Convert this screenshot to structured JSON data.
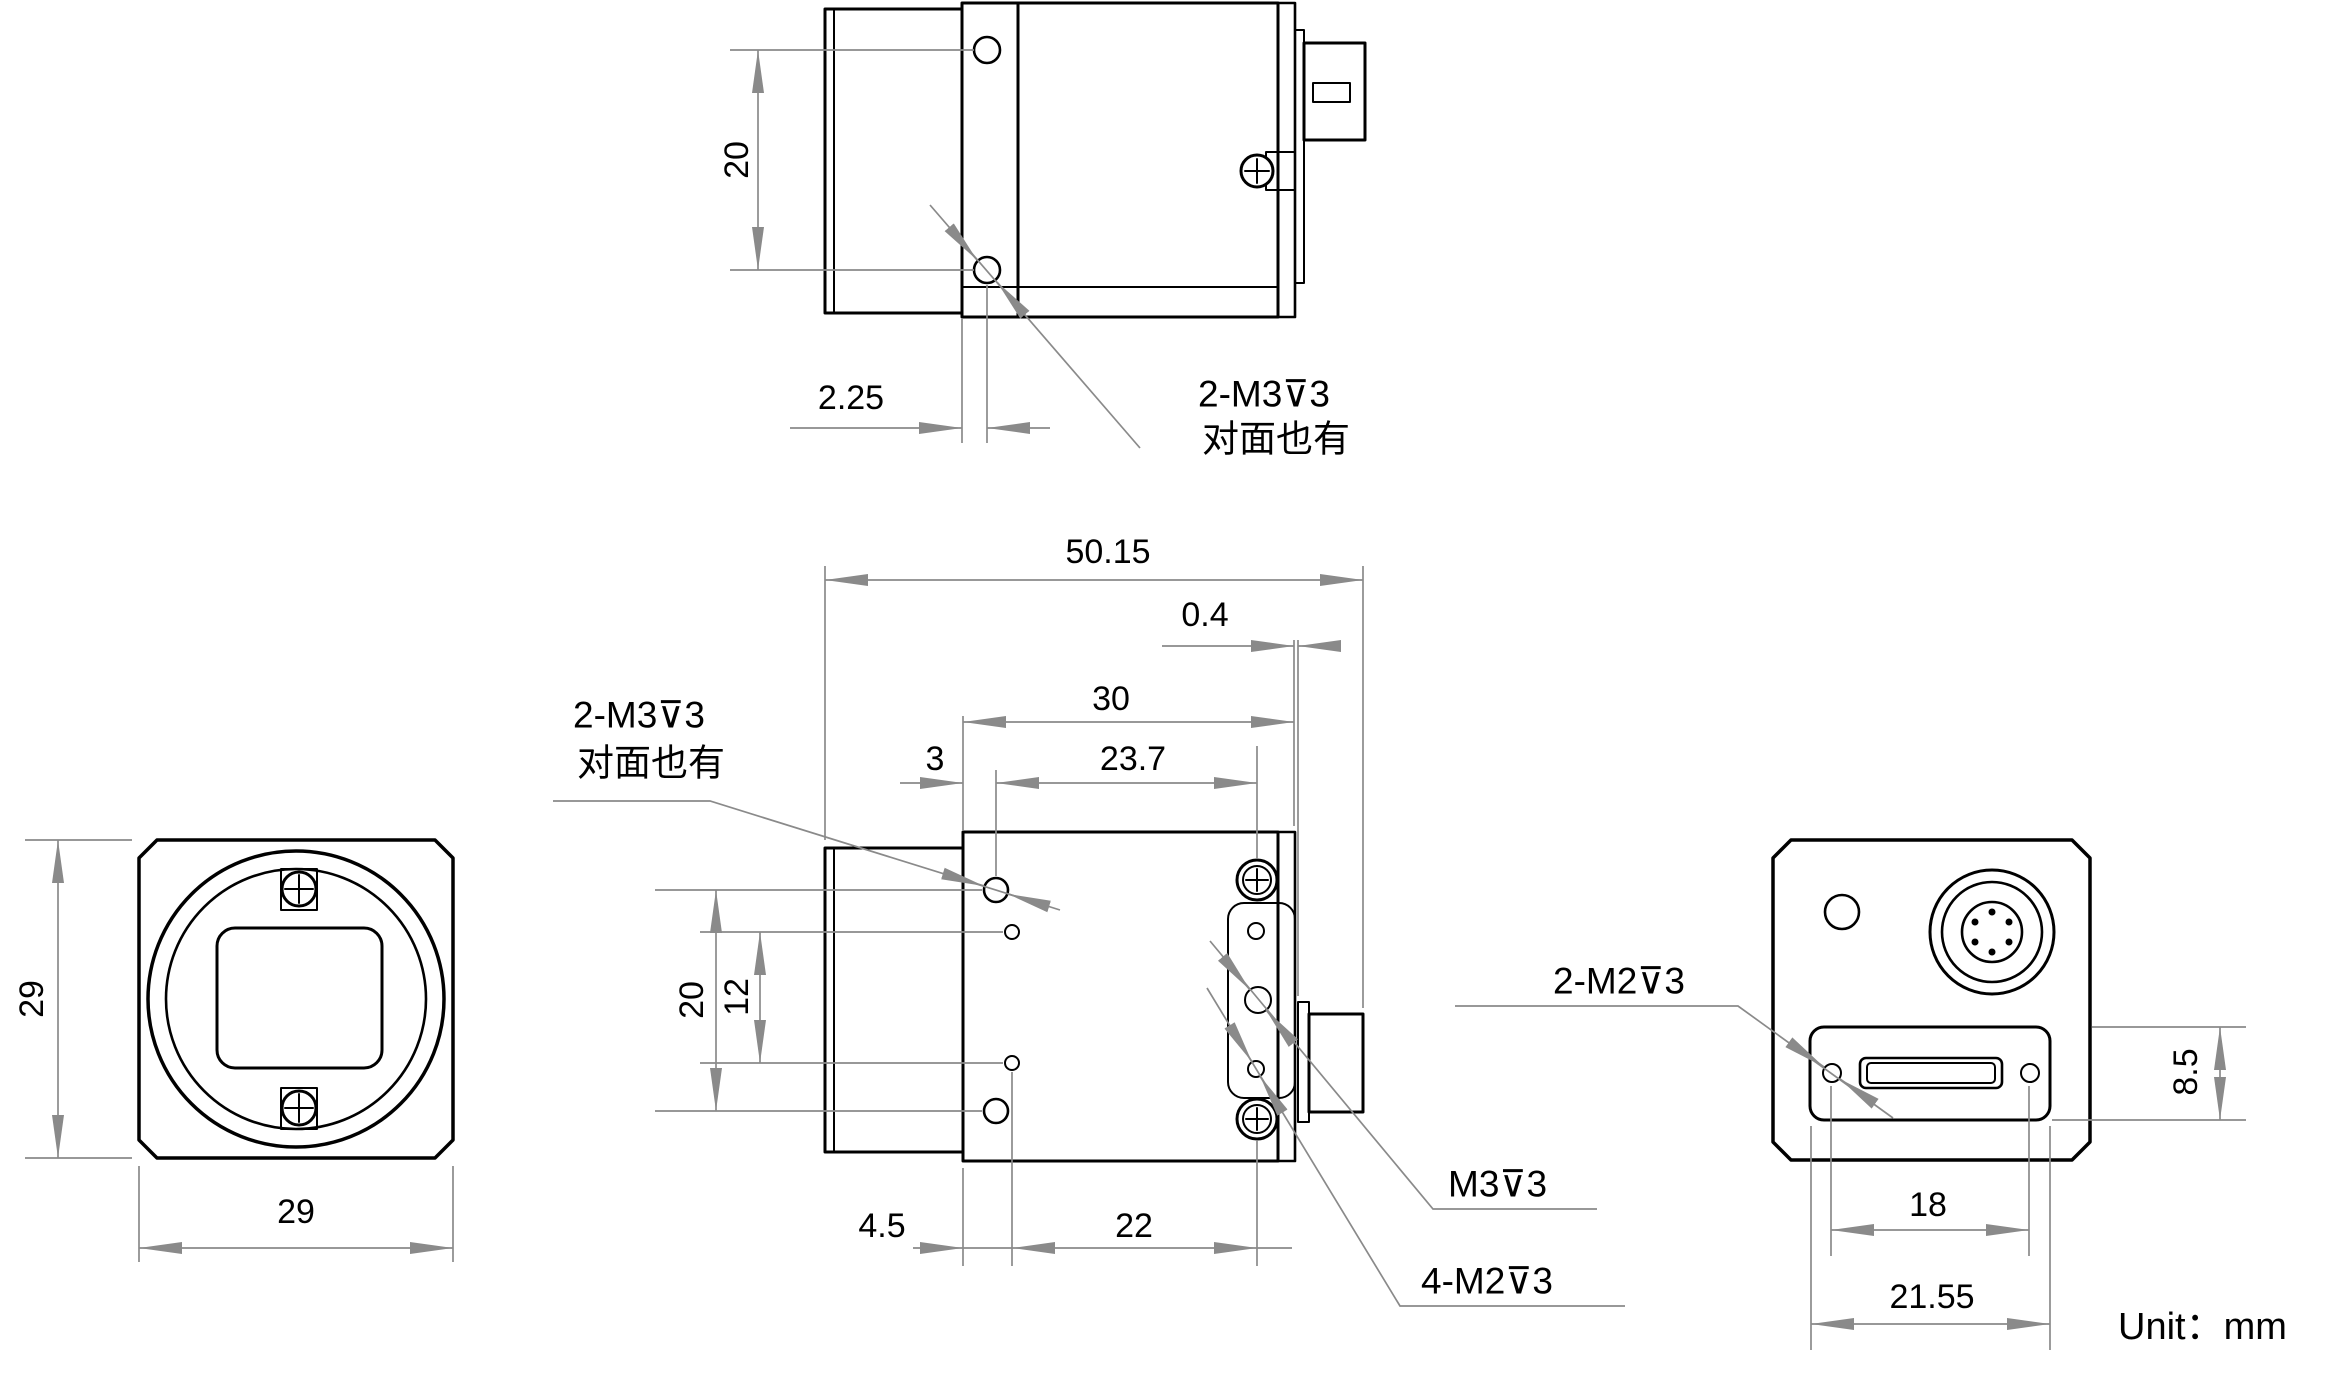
{
  "colors": {
    "edge_line": "#000000",
    "dimension_line": "#8a8a8a",
    "text": "#000000"
  },
  "unit_label": "Unit：mm",
  "top_view": {
    "dim_hole_spacing": "20",
    "dim_hole_offset": "2.25",
    "callout_line1": "2-M3⊽3",
    "callout_line2": "对面也有"
  },
  "front_view": {
    "dim_height": "29",
    "dim_width": "29"
  },
  "side_view": {
    "dim_total_length": "50.15",
    "dim_plate_gap": "0.4",
    "dim_body_length": "30",
    "dim_screw_offset": "23.7",
    "dim_m3_offset": "3",
    "dim_m3_spacing": "20",
    "dim_m2_spacing": "12",
    "dim_m2_offset": "4.5",
    "dim_m2_to_screw": "22",
    "callout_m3_line1": "2-M3⊽3",
    "callout_m3_line2": "对面也有",
    "callout_m3_depth": "M3⊽3",
    "callout_4m2_depth": "4-M2⊽3"
  },
  "rear_view": {
    "dim_slot_height": "8.5",
    "dim_screw_spacing": "18",
    "dim_slot_width": "21.55",
    "callout_2m2_depth": "2-M2⊽3"
  }
}
